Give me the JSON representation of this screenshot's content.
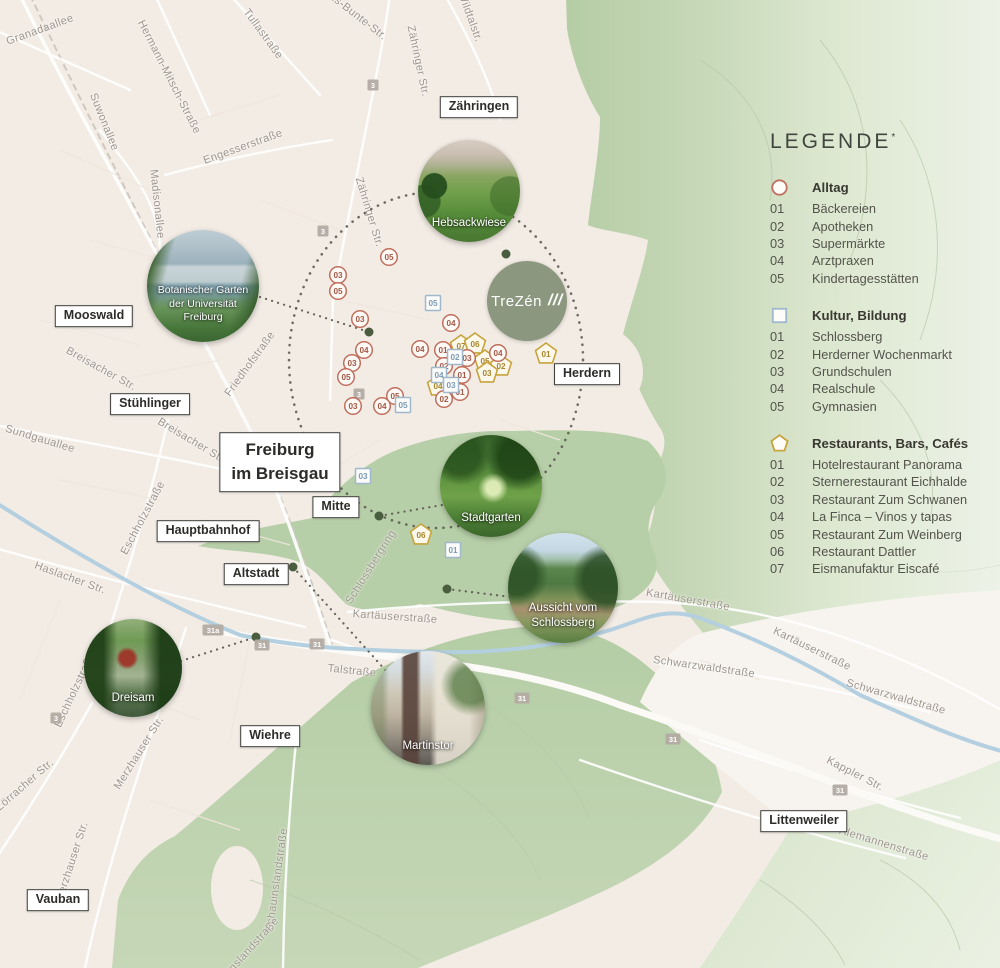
{
  "logo": {
    "text": "TreZén",
    "slashes": "///",
    "x": 527,
    "y": 301,
    "r": 40
  },
  "legend": {
    "title": "LEGENDE",
    "superscript": "*",
    "sections": [
      {
        "key": "alltag",
        "shape": "circle",
        "color": "#c06f5e",
        "text_color": "#a65847",
        "header": "Alltag",
        "items": [
          {
            "num": "01",
            "label": "Bäckereien"
          },
          {
            "num": "02",
            "label": "Apotheken"
          },
          {
            "num": "03",
            "label": "Supermärkte"
          },
          {
            "num": "04",
            "label": "Arztpraxen"
          },
          {
            "num": "05",
            "label": "Kindertagesstätten"
          }
        ]
      },
      {
        "key": "kultur",
        "shape": "square",
        "color": "#9fb8cc",
        "text_color": "#7d9cb6",
        "header": "Kultur, Bildung",
        "items": [
          {
            "num": "01",
            "label": "Schlossberg"
          },
          {
            "num": "02",
            "label": "Herderner Wochenmarkt"
          },
          {
            "num": "03",
            "label": "Grundschulen"
          },
          {
            "num": "04",
            "label": "Realschule"
          },
          {
            "num": "05",
            "label": "Gymnasien"
          }
        ]
      },
      {
        "key": "restaurants",
        "shape": "pentagon",
        "color": "#c7a43c",
        "text_color": "#a8872c",
        "header": "Restaurants, Bars, Cafés",
        "items": [
          {
            "num": "01",
            "label": "Hotelrestaurant Panorama"
          },
          {
            "num": "02",
            "label": "Sternerestaurant Eichhalde"
          },
          {
            "num": "03",
            "label": "Restaurant Zum Schwanen"
          },
          {
            "num": "04",
            "label": "La Finca – Vinos y tapas"
          },
          {
            "num": "05",
            "label": "Restaurant Zum Weinberg"
          },
          {
            "num": "06",
            "label": "Restaurant Dattler"
          },
          {
            "num": "07",
            "label": "Eismanufaktur Eiscafé"
          }
        ]
      }
    ]
  },
  "map": {
    "districts": [
      {
        "lines": [
          "Zähringen"
        ],
        "x": 479,
        "y": 107
      },
      {
        "lines": [
          "Mooswald"
        ],
        "x": 94,
        "y": 316
      },
      {
        "lines": [
          "Stühlinger"
        ],
        "x": 150,
        "y": 404
      },
      {
        "lines": [
          "Freiburg",
          "im Breisgau"
        ],
        "x": 280,
        "y": 462,
        "large": true
      },
      {
        "lines": [
          "Mitte"
        ],
        "x": 336,
        "y": 507
      },
      {
        "lines": [
          "Hauptbahnhof"
        ],
        "x": 208,
        "y": 531
      },
      {
        "lines": [
          "Altstadt"
        ],
        "x": 256,
        "y": 574
      },
      {
        "lines": [
          "Herdern"
        ],
        "x": 587,
        "y": 374
      },
      {
        "lines": [
          "Wiehre"
        ],
        "x": 270,
        "y": 736
      },
      {
        "lines": [
          "Vauban"
        ],
        "x": 58,
        "y": 900
      },
      {
        "lines": [
          "Littenweiler"
        ],
        "x": 804,
        "y": 821
      }
    ],
    "streets": [
      {
        "name": "Granadaallee",
        "x": 40,
        "y": 30,
        "rot": -20
      },
      {
        "name": "Suwonallee",
        "x": 104,
        "y": 122,
        "rot": 68
      },
      {
        "name": "Hermann-Mitsch-Straße",
        "x": 169,
        "y": 77,
        "rot": 63
      },
      {
        "name": "Tullastraße",
        "x": 263,
        "y": 34,
        "rot": 54
      },
      {
        "name": "Engesserstraße",
        "x": 243,
        "y": 147,
        "rot": -20
      },
      {
        "name": "Madisonallee",
        "x": 157,
        "y": 204,
        "rot": 84
      },
      {
        "name": "Hans-Bunte-Str.",
        "x": 352,
        "y": 12,
        "rot": 38
      },
      {
        "name": "Zähringer Str.",
        "x": 418,
        "y": 61,
        "rot": 78
      },
      {
        "name": "Zähringer Str.",
        "x": 369,
        "y": 212,
        "rot": 73
      },
      {
        "name": "Wildtalstr.",
        "x": 470,
        "y": 17,
        "rot": 70
      },
      {
        "name": "Breisacher Str.",
        "x": 101,
        "y": 369,
        "rot": 29
      },
      {
        "name": "Breisacher Str.",
        "x": 192,
        "y": 441,
        "rot": 31
      },
      {
        "name": "Friedhofstraße",
        "x": 250,
        "y": 364,
        "rot": -54
      },
      {
        "name": "Sundgauallee",
        "x": 40,
        "y": 439,
        "rot": 17
      },
      {
        "name": "Eschholzstraße",
        "x": 143,
        "y": 518,
        "rot": -62
      },
      {
        "name": "Eschholzstraße",
        "x": 75,
        "y": 690,
        "rot": -65
      },
      {
        "name": "Haslacher Str.",
        "x": 70,
        "y": 578,
        "rot": 20
      },
      {
        "name": "Lörracher Str.",
        "x": 25,
        "y": 785,
        "rot": -41
      },
      {
        "name": "Merzhauser Str.",
        "x": 139,
        "y": 753,
        "rot": -58
      },
      {
        "name": "Merzhauser Str.",
        "x": 72,
        "y": 862,
        "rot": -72
      },
      {
        "name": "Schauinslandstraße",
        "x": 277,
        "y": 880,
        "rot": -82
      },
      {
        "name": "Schauinslandstraße",
        "x": 242,
        "y": 958,
        "rot": -48
      },
      {
        "name": "Talstraße",
        "x": 352,
        "y": 671,
        "rot": 6
      },
      {
        "name": "Kartäuserstraße",
        "x": 395,
        "y": 617,
        "rot": 4
      },
      {
        "name": "Kartäuserstraße",
        "x": 688,
        "y": 600,
        "rot": 10
      },
      {
        "name": "Kartäuserstraße",
        "x": 812,
        "y": 649,
        "rot": 26
      },
      {
        "name": "Schwarzwaldstraße",
        "x": 704,
        "y": 667,
        "rot": 8
      },
      {
        "name": "Schwarzwaldstraße",
        "x": 896,
        "y": 697,
        "rot": 16
      },
      {
        "name": "Kappler Str.",
        "x": 855,
        "y": 774,
        "rot": 27
      },
      {
        "name": "Alemannenstraße",
        "x": 884,
        "y": 844,
        "rot": 17
      },
      {
        "name": "Schlossbergring",
        "x": 371,
        "y": 567,
        "rot": -58
      }
    ],
    "photos": [
      {
        "id": "hebsackwiese",
        "x": 469,
        "y": 191,
        "r": 51,
        "caption": [
          "Hebsackwiese"
        ]
      },
      {
        "id": "botanischer-garten",
        "x": 203,
        "y": 286,
        "r": 56,
        "caption": [
          "Botanischer Garten",
          "der Universität",
          "Freiburg"
        ]
      },
      {
        "id": "stadtgarten",
        "x": 491,
        "y": 486,
        "r": 51,
        "caption": [
          "Stadtgarten"
        ]
      },
      {
        "id": "aussicht-schlossberg",
        "x": 563,
        "y": 588,
        "r": 55,
        "caption": [
          "Aussicht vom",
          "Schlossberg"
        ]
      },
      {
        "id": "dreisam",
        "x": 133,
        "y": 668,
        "r": 49,
        "caption": [
          "Dreisam"
        ]
      },
      {
        "id": "martinstor",
        "x": 428,
        "y": 708,
        "r": 57,
        "caption": [
          "Martinstor"
        ]
      }
    ],
    "markers": {
      "alltag": [
        {
          "num": "05",
          "x": 389,
          "y": 257
        },
        {
          "num": "03",
          "x": 338,
          "y": 275
        },
        {
          "num": "05",
          "x": 338,
          "y": 291
        },
        {
          "num": "03",
          "x": 360,
          "y": 319
        },
        {
          "num": "04",
          "x": 451,
          "y": 323
        },
        {
          "num": "04",
          "x": 364,
          "y": 350
        },
        {
          "num": "04",
          "x": 420,
          "y": 349
        },
        {
          "num": "01",
          "x": 443,
          "y": 350
        },
        {
          "num": "03",
          "x": 352,
          "y": 363
        },
        {
          "num": "03",
          "x": 467,
          "y": 358
        },
        {
          "num": "04",
          "x": 498,
          "y": 353
        },
        {
          "num": "02",
          "x": 444,
          "y": 366
        },
        {
          "num": "05",
          "x": 346,
          "y": 377
        },
        {
          "num": "01",
          "x": 462,
          "y": 375
        },
        {
          "num": "01",
          "x": 460,
          "y": 392
        },
        {
          "num": "02",
          "x": 444,
          "y": 399
        },
        {
          "num": "05",
          "x": 395,
          "y": 396
        },
        {
          "num": "04",
          "x": 382,
          "y": 406
        },
        {
          "num": "03",
          "x": 353,
          "y": 406
        }
      ],
      "kultur": [
        {
          "num": "05",
          "x": 433,
          "y": 303
        },
        {
          "num": "02",
          "x": 455,
          "y": 357
        },
        {
          "num": "04",
          "x": 439,
          "y": 375
        },
        {
          "num": "03",
          "x": 451,
          "y": 385
        },
        {
          "num": "05",
          "x": 403,
          "y": 405
        },
        {
          "num": "03",
          "x": 363,
          "y": 476
        },
        {
          "num": "01",
          "x": 453,
          "y": 550
        }
      ],
      "restaurants": [
        {
          "num": "07",
          "x": 461,
          "y": 346
        },
        {
          "num": "06",
          "x": 475,
          "y": 344
        },
        {
          "num": "05",
          "x": 485,
          "y": 361
        },
        {
          "num": "02",
          "x": 501,
          "y": 366
        },
        {
          "num": "03",
          "x": 487,
          "y": 373
        },
        {
          "num": "04",
          "x": 438,
          "y": 386
        },
        {
          "num": "01",
          "x": 546,
          "y": 354
        },
        {
          "num": "06",
          "x": 421,
          "y": 535
        }
      ]
    },
    "road_badges": [
      {
        "label": "3",
        "x": 373,
        "y": 85
      },
      {
        "label": "3",
        "x": 323,
        "y": 231
      },
      {
        "label": "3",
        "x": 359,
        "y": 394
      },
      {
        "label": "3",
        "x": 56,
        "y": 718
      },
      {
        "label": "31a",
        "x": 213,
        "y": 630
      },
      {
        "label": "31",
        "x": 262,
        "y": 645
      },
      {
        "label": "31",
        "x": 317,
        "y": 644
      },
      {
        "label": "31",
        "x": 522,
        "y": 698
      },
      {
        "label": "31",
        "x": 673,
        "y": 739
      },
      {
        "label": "31",
        "x": 840,
        "y": 790
      }
    ],
    "ring": {
      "cx": 436,
      "cy": 360,
      "rx": 147,
      "ry": 168
    },
    "location_dots": [
      {
        "x": 369,
        "y": 332
      },
      {
        "x": 506,
        "y": 254
      },
      {
        "x": 379,
        "y": 516
      },
      {
        "x": 293,
        "y": 567
      },
      {
        "x": 256,
        "y": 637
      },
      {
        "x": 447,
        "y": 589
      }
    ],
    "connectors": [
      {
        "x1": 260,
        "y1": 297,
        "x2": 369,
        "y2": 332
      },
      {
        "x1": 448,
        "y1": 504,
        "x2": 379,
        "y2": 516
      },
      {
        "x1": 447,
        "y1": 589,
        "x2": 511,
        "y2": 597
      },
      {
        "x1": 293,
        "y1": 567,
        "x2": 387,
        "y2": 672
      },
      {
        "x1": 181,
        "y1": 661,
        "x2": 256,
        "y2": 637
      }
    ]
  },
  "colors": {
    "map_base": "#f3ece5",
    "forest_green": "#b6cea7",
    "logo_bg": "#8b977e",
    "route_dots": "#57554e",
    "location_dot": "#4a5e3f",
    "alltag": "#c06f5e",
    "kultur": "#9fb8cc",
    "restaurants": "#c7a43c"
  }
}
